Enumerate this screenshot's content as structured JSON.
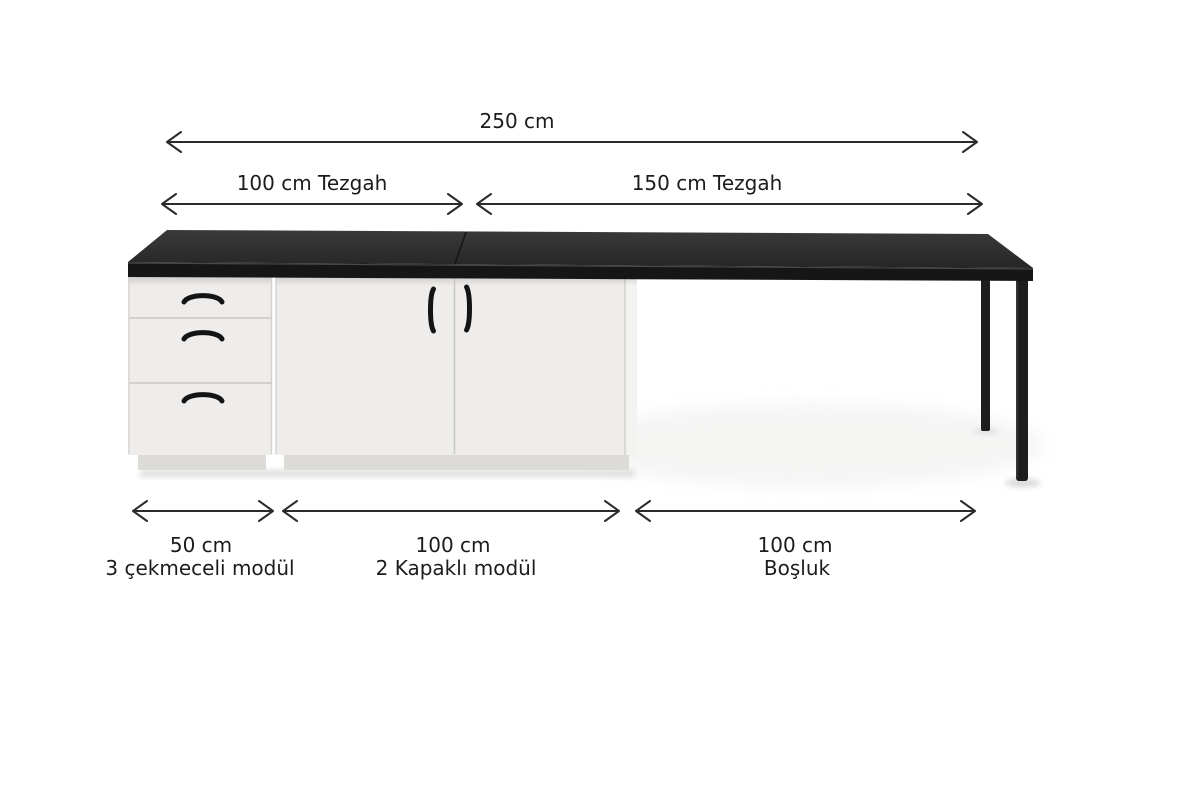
{
  "diagram": {
    "kind": "kitchen-counter-module-dimension-diagram",
    "total_width_label": "250 cm",
    "counter_sections": [
      {
        "label": "100 cm Tezgah"
      },
      {
        "label": "150 cm Tezgah"
      }
    ],
    "modules": [
      {
        "width_label": "50 cm",
        "name": "3 çekmeceli modül"
      },
      {
        "width_label": "100 cm",
        "name": "2 Kapaklı modül"
      },
      {
        "width_label": "100 cm",
        "name": "Boşluk"
      }
    ]
  },
  "colors": {
    "background": "#ffffff",
    "text": "#1c1c1c",
    "arrow": "#2b2b2b",
    "countertop_top": "#2e2e2e",
    "countertop_front": "#161616",
    "cabinet": "#eeedeb",
    "cabinet_side": "#f4f3f1",
    "plinth": "#dcdbd8",
    "panel_line": "#c9c8c5",
    "handle": "#141414",
    "leg": "#1e1e1e"
  }
}
